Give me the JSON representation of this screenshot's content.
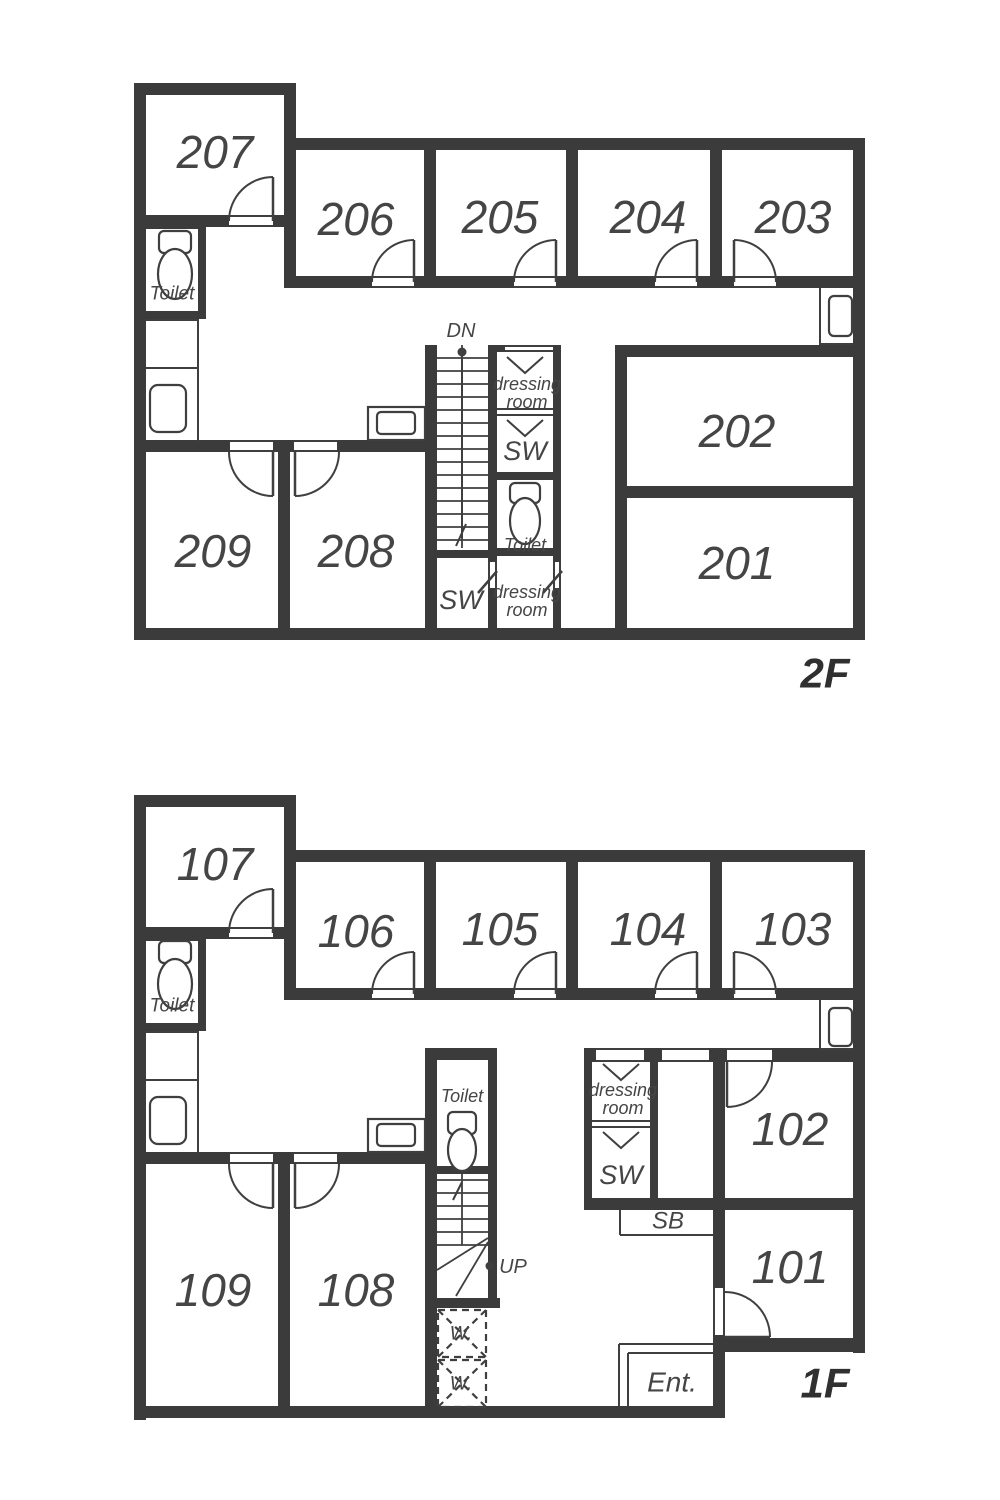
{
  "title": "Two-floor apartment floor plan",
  "colors": {
    "wall": "#3b3b3b",
    "line": "#3f3f3f",
    "text": "#454545",
    "background": "#ffffff"
  },
  "floor2": {
    "label": "2F",
    "stair_direction": "DN",
    "rooms": [
      "201",
      "202",
      "203",
      "204",
      "205",
      "206",
      "207",
      "208",
      "209"
    ]
  },
  "floor1": {
    "label": "1F",
    "stair_direction": "UP",
    "rooms": [
      "101",
      "102",
      "103",
      "104",
      "105",
      "106",
      "107",
      "108",
      "109"
    ],
    "entrance": "Ent.",
    "shoe_box": "SB",
    "washer": "W."
  },
  "shared": {
    "toilet": "Toilet",
    "shower_room": "SW",
    "dressing_line1": "dressing",
    "dressing_line2": "room"
  }
}
